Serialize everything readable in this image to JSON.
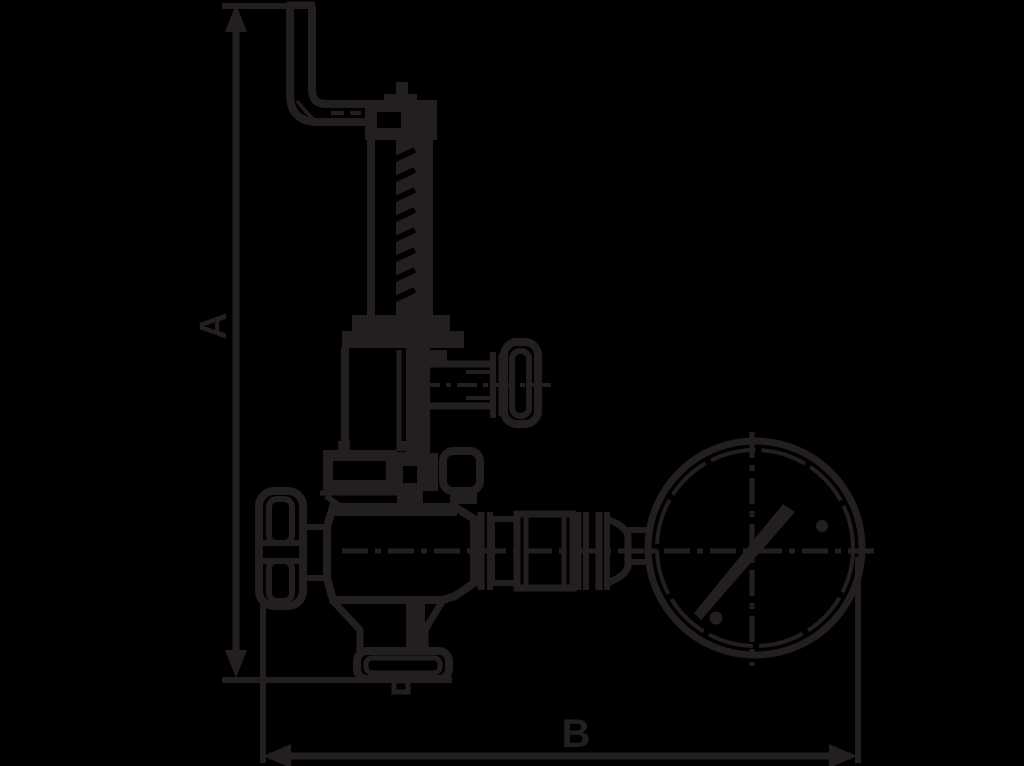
{
  "figure": {
    "kind": "technical-line-drawing",
    "subject": "relief valve with test lever, shut-off handwheel and pressure gauge",
    "background_color": "#000000",
    "line_color": "#231f20",
    "dim_a_label": "A",
    "dim_b_label": "B"
  }
}
